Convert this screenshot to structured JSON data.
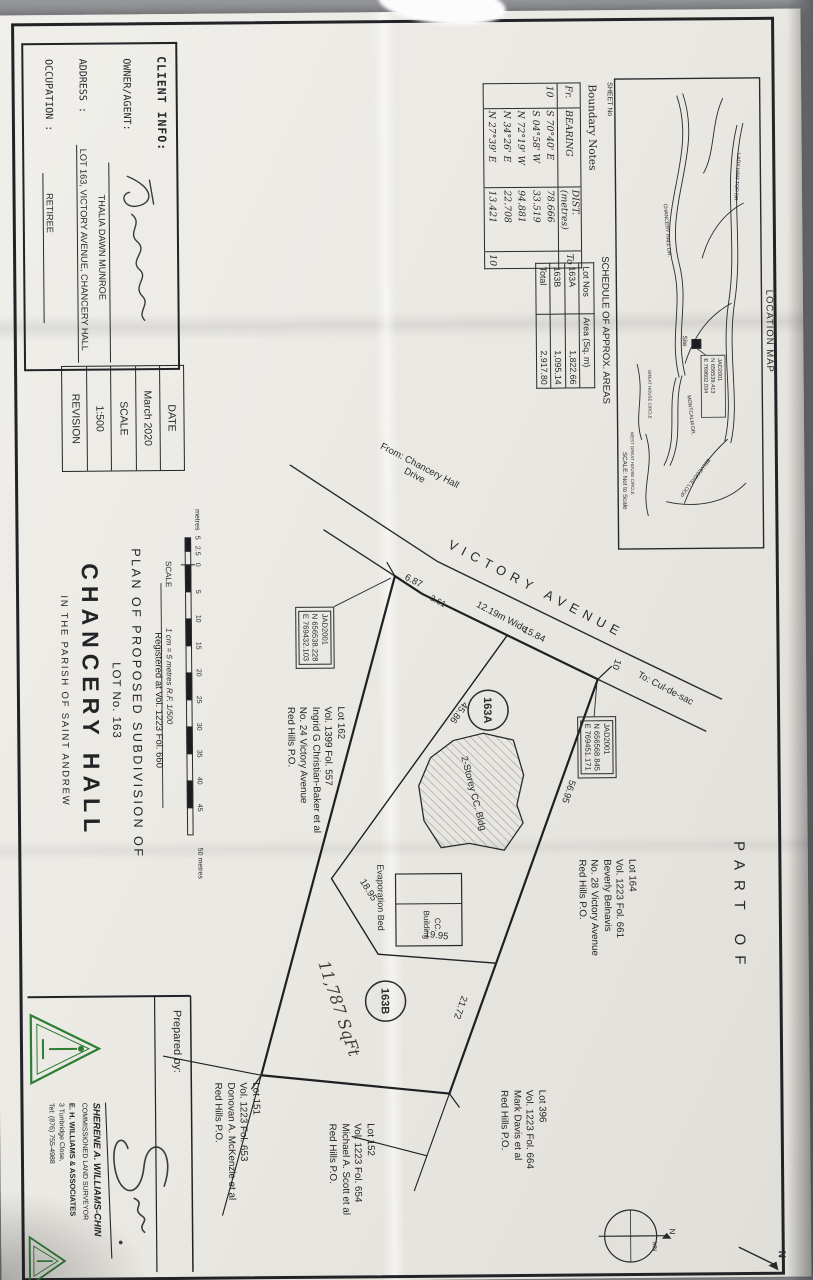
{
  "colors": {
    "paper": "#e9e7e1",
    "ink": "#2a2a2e",
    "logo_green": "#2e7d32"
  },
  "location_map": {
    "title": "LOCATION MAP",
    "sheet_no": "SHEET No",
    "scale_note": "SCALE: Not to Scale",
    "site_label": "Site",
    "site_coord": {
      "l1": "JAD2001",
      "l2": "N 656539.413",
      "l3": "E 769602.034"
    },
    "roads": [
      "LADY HAM TOR DR",
      "CHANCERY HALL DR.",
      "MONTCALM DR.",
      "BELVEDERE LOOP",
      "WEST GREAT HOUSE CIRCLE",
      "GREAT HOUSE CIRCLE"
    ]
  },
  "boundary_notes": {
    "title": "Boundary Notes",
    "headers": {
      "fr": "Fr.",
      "bearing": "BEARING",
      "dist": "DIST.",
      "dist_unit": "(metres)",
      "to": "To"
    },
    "rows": [
      {
        "fr": "10",
        "bearing": "S 70°40' E",
        "dist": "78.666",
        "to": ""
      },
      {
        "fr": "",
        "bearing": "S 04°58' W",
        "dist": "33.519",
        "to": ""
      },
      {
        "fr": "",
        "bearing": "N 72°19' W",
        "dist": "94.881",
        "to": ""
      },
      {
        "fr": "",
        "bearing": "N 34°26' E",
        "dist": "22.708",
        "to": ""
      },
      {
        "fr": "",
        "bearing": "N 27°39' E",
        "dist": "13.421",
        "to": "10"
      }
    ]
  },
  "schedule": {
    "title": "SCHEDULE OF APPROX. AREAS",
    "headers": {
      "lot": "Lot Nos",
      "area": "Area (Sq. m)"
    },
    "rows": [
      {
        "lot": "163A",
        "area": "1,822.66"
      },
      {
        "lot": "163B",
        "area": "1,095.14"
      },
      {
        "lot": "Total",
        "area": "2,917.80"
      }
    ]
  },
  "part_of": "PART  OF",
  "plan": {
    "road_name": "VICTORY   AVENUE",
    "road_width": "12.19m Wide",
    "road_from_1": "From: Chancery Hall",
    "road_from_2": "Drive",
    "road_to": "To: Cul-de-sac",
    "corner": "10",
    "dims": {
      "frontage_a": "6.87",
      "frontage_b": "3.61",
      "frontage_c": "15.84",
      "north_a": "56.95",
      "north_b": "21.72",
      "internal_a": "45.86",
      "internal_b": "18.95",
      "internal_c": "19.95"
    },
    "lot_a": "163A",
    "lot_b": "163B",
    "building": "2-Storey CC. Bldg",
    "evap": "Evaporation Bed",
    "cc_1": "CC.",
    "cc_2": "Building",
    "handwritten": "11,787 SqFt",
    "coord1": {
      "l1": "JAD2001",
      "l2": "N 656538.228",
      "l3": "E 769432.103"
    },
    "coord2": {
      "l1": "JAD2001",
      "l2": "N 656568.845",
      "l3": "E 769451.171"
    },
    "neighbors": [
      {
        "lot": "Lot 164",
        "vol": "Vol. 1223 Fol. 661",
        "owner": "Beverly Belnavis",
        "address": "No. 28 Victory Avenue",
        "po": "Red Hills P.O."
      },
      {
        "lot": "Lot 162",
        "vol": "Vol. 1399 Fol. 557",
        "owner": "Ingrid G Christian-Baker et al",
        "address": "No. 24 Victory Avenue",
        "po": "Red Hills P.O."
      },
      {
        "lot": "Lot 396",
        "vol": "Vol. 1223 Fol. 664",
        "owner": "Mark Davis et al",
        "po": "Red Hills P.O."
      },
      {
        "lot": "Lot 152",
        "vol": "Vol. 1223 Fol. 654",
        "owner": "Michael A. Scott et al",
        "po": "Red Hills P.O."
      },
      {
        "lot": "Lot 151",
        "vol": "Vol. 1223 Fol. 653",
        "owner": "Donovan A. McKenzie et al",
        "po": "Red Hills P.O."
      }
    ]
  },
  "client_info": {
    "header": "CLIENT INFO:",
    "owner_label": "OWNER/AGENT:",
    "owner_value": "THALIA DAWN MUNROE",
    "address_label": "ADDRESS :",
    "address_value": "LOT 163, VICTORY AVENUE, CHANCERY HALL",
    "occupation_label": "OCCUPATION :",
    "occupation_value": "RETIREE"
  },
  "date_box": {
    "date_label": "DATE",
    "date_value": "March 2020",
    "scale_label": "SCALE",
    "scale_value": "1:500",
    "revision_label": "REVISION"
  },
  "scale_bar": {
    "unit_left": "metres",
    "left_labels": [
      "5",
      "2.5",
      "0"
    ],
    "ticks": [
      "5",
      "10",
      "15",
      "20",
      "25",
      "30",
      "35",
      "40",
      "45"
    ],
    "end_label": "50 metres",
    "caption_label": "SCALE",
    "caption": "1 cm = 5 metres    R.F. 1/500"
  },
  "title_block": {
    "registered": "Registered at Vol. 1223 Fol. 660",
    "line1": "PLAN OF PROPOSED SUBDIVISION  OF",
    "line2": "LOT No. 163",
    "line3": "CHANCERY HALL",
    "line4": "IN THE PARISH OF SAINT ANDREW"
  },
  "prepared": {
    "label": "Prepared by:",
    "name": "SHERENE A. WILLIAMS-CHIN",
    "title": "COMMISSIONED LAND SURVEYOR",
    "company": "E. H. WILLIAMS & ASSOCIATES",
    "address": "3 Tunbridge Close,",
    "phone": "Tel: (876) 755-4988"
  },
  "compass": {
    "n": "N",
    "mn": "MN",
    "corner_n": "N"
  }
}
